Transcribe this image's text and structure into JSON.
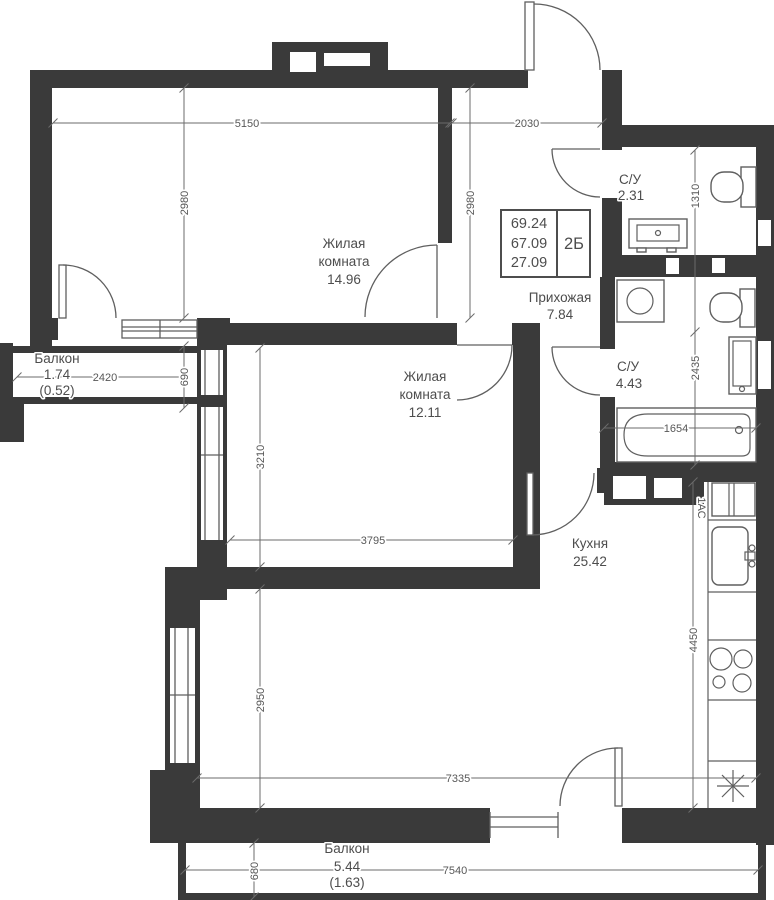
{
  "info_box": {
    "area_total": "69.24",
    "area_no_balcony": "67.09",
    "area_living": "27.09",
    "flat_type": "2Б"
  },
  "rooms": {
    "living1": {
      "name1": "Жилая",
      "name2": "комната",
      "area": "14.96"
    },
    "living2": {
      "name1": "Жилая",
      "name2": "комната",
      "area": "12.11"
    },
    "hall": {
      "name": "Прихожая",
      "area": "7.84"
    },
    "bath1": {
      "name": "С/У",
      "area": "2.31"
    },
    "bath2": {
      "name": "С/У",
      "area": "4.43"
    },
    "kitchen": {
      "name": "Кухня",
      "area": "25.42"
    },
    "balcony_west": {
      "name": "Балкон",
      "area": "1.74",
      "area_coeff": "(0.52)"
    },
    "balcony_south": {
      "name": "Балкон",
      "area": "5.44",
      "area_coeff": "(1.63)"
    }
  },
  "dimensions": {
    "room1_width": "5150",
    "hall_width": "2030",
    "room1_height_left": "2980",
    "room1_height_right": "2980",
    "bath1_height": "1310",
    "bath2_height": "2435",
    "bath_length": "1654",
    "balcony_west_width": "2420",
    "balcony_west_depth": "690",
    "room2_height": "3210",
    "room2_width": "3795",
    "kitchen_height_left": "2950",
    "kitchen_height_right": "4450",
    "kitchen_width": "7335",
    "balcony_south_width": "7540",
    "balcony_south_depth": "680",
    "shaft_label": "1АС"
  },
  "colors": {
    "wall": "#3a3a3a",
    "line": "#5f5f5f",
    "dim_text": "#575757",
    "room_text": "#4d4d4d",
    "background": "#ffffff"
  }
}
